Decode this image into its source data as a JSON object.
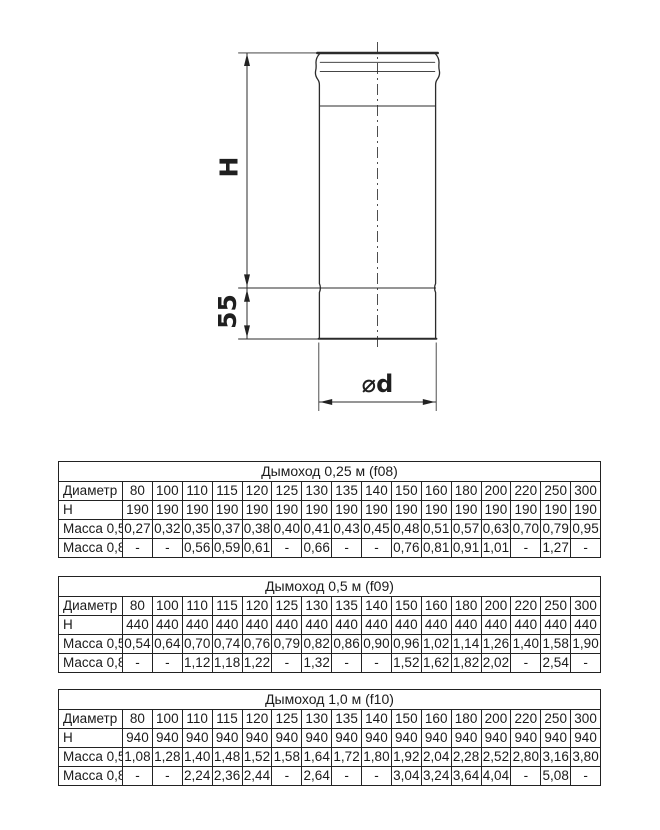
{
  "drawing": {
    "h_label": "H",
    "socket_label": "55",
    "diameter_label": "⌀d"
  },
  "colors": {
    "ink": "#222222",
    "thin_line": "#3c3c3c",
    "background": "#ffffff"
  },
  "tables": [
    {
      "title": "Дымоход 0,25 м (f08)",
      "rows": [
        {
          "label": "Диаметр",
          "values": [
            "80",
            "100",
            "110",
            "115",
            "120",
            "125",
            "130",
            "135",
            "140",
            "150",
            "160",
            "180",
            "200",
            "220",
            "250",
            "300"
          ]
        },
        {
          "label": "Н",
          "values": [
            "190",
            "190",
            "190",
            "190",
            "190",
            "190",
            "190",
            "190",
            "190",
            "190",
            "190",
            "190",
            "190",
            "190",
            "190",
            "190"
          ]
        },
        {
          "label": "Масса 0,5",
          "values": [
            "0,27",
            "0,32",
            "0,35",
            "0,37",
            "0,38",
            "0,40",
            "0,41",
            "0,43",
            "0,45",
            "0,48",
            "0,51",
            "0,57",
            "0,63",
            "0,70",
            "0,79",
            "0,95"
          ]
        },
        {
          "label": "Масса 0,8",
          "values": [
            "-",
            "-",
            "0,56",
            "0,59",
            "0,61",
            "-",
            "0,66",
            "-",
            "-",
            "0,76",
            "0,81",
            "0,91",
            "1,01",
            "-",
            "1,27",
            "-"
          ]
        }
      ]
    },
    {
      "title": "Дымоход 0,5 м (f09)",
      "rows": [
        {
          "label": "Диаметр",
          "values": [
            "80",
            "100",
            "110",
            "115",
            "120",
            "125",
            "130",
            "135",
            "140",
            "150",
            "160",
            "180",
            "200",
            "220",
            "250",
            "300"
          ]
        },
        {
          "label": "Н",
          "values": [
            "440",
            "440",
            "440",
            "440",
            "440",
            "440",
            "440",
            "440",
            "440",
            "440",
            "440",
            "440",
            "440",
            "440",
            "440",
            "440"
          ]
        },
        {
          "label": "Масса 0,5",
          "values": [
            "0,54",
            "0,64",
            "0,70",
            "0,74",
            "0,76",
            "0,79",
            "0,82",
            "0,86",
            "0,90",
            "0,96",
            "1,02",
            "1,14",
            "1,26",
            "1,40",
            "1,58",
            "1,90"
          ]
        },
        {
          "label": "Масса 0,8",
          "values": [
            "-",
            "-",
            "1,12",
            "1,18",
            "1,22",
            "-",
            "1,32",
            "-",
            "-",
            "1,52",
            "1,62",
            "1,82",
            "2,02",
            "-",
            "2,54",
            "-"
          ]
        }
      ]
    },
    {
      "title": "Дымоход 1,0 м (f10)",
      "rows": [
        {
          "label": "Диаметр",
          "values": [
            "80",
            "100",
            "110",
            "115",
            "120",
            "125",
            "130",
            "135",
            "140",
            "150",
            "160",
            "180",
            "200",
            "220",
            "250",
            "300"
          ]
        },
        {
          "label": "Н",
          "values": [
            "940",
            "940",
            "940",
            "940",
            "940",
            "940",
            "940",
            "940",
            "940",
            "940",
            "940",
            "940",
            "940",
            "940",
            "940",
            "940"
          ]
        },
        {
          "label": "Масса 0,5",
          "values": [
            "1,08",
            "1,28",
            "1,40",
            "1,48",
            "1,52",
            "1,58",
            "1,64",
            "1,72",
            "1,80",
            "1,92",
            "2,04",
            "2,28",
            "2,52",
            "2,80",
            "3,16",
            "3,80"
          ]
        },
        {
          "label": "Масса 0,8",
          "values": [
            "-",
            "-",
            "2,24",
            "2,36",
            "2,44",
            "-",
            "2,64",
            "-",
            "-",
            "3,04",
            "3,24",
            "3,64",
            "4,04",
            "-",
            "5,08",
            "-"
          ]
        }
      ]
    }
  ]
}
